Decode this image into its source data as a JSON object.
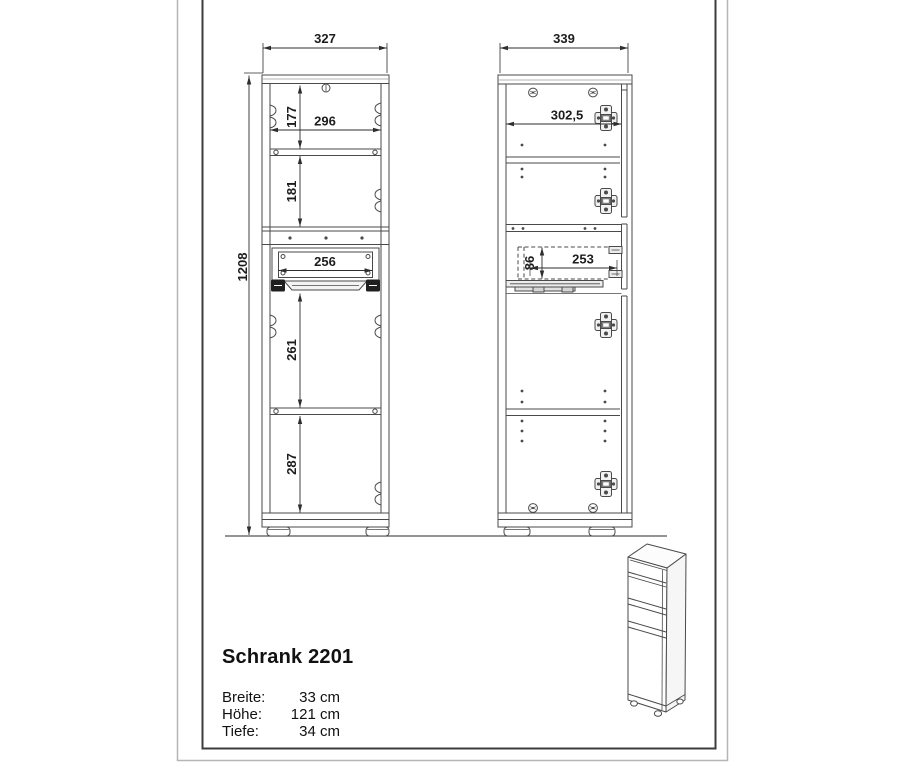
{
  "colors": {
    "drawing_line": "#4a4a4a",
    "dimension_line": "#2e2e2e",
    "frame_outer": "#b5b5b5",
    "frame_inner": "#3c3c3c"
  },
  "front_view": {
    "dims": {
      "overall_width": "327",
      "overall_height": "1208",
      "interior_width": "296",
      "top_compartment": "177",
      "middle_compartment": "181",
      "drawer_width": "256",
      "lower_compartment": "261",
      "bottom_compartment": "287"
    }
  },
  "side_view": {
    "dims": {
      "overall_depth": "339",
      "interior_depth": "302,5",
      "drawer_height": "86",
      "drawer_depth": "253"
    }
  },
  "title_block": {
    "model": "Schrank 2201",
    "specs": [
      {
        "label": "Breite:",
        "value": "33 cm"
      },
      {
        "label": "Höhe:",
        "value": "121 cm"
      },
      {
        "label": "Tiefe:",
        "value": "34 cm"
      }
    ]
  }
}
